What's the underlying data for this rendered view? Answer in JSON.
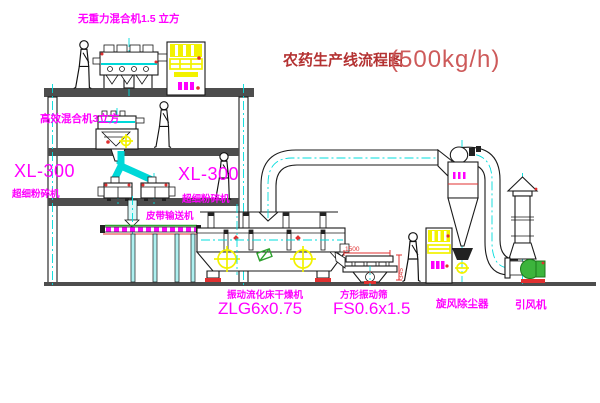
{
  "title": {
    "text": "农药生产线流程图",
    "capacity": "(500kg/h)"
  },
  "labels": {
    "gravity_mixer": "无重力混合机1.5 立方",
    "high_eff_mixer": "高效混合机3立方",
    "mill_left_model": "XL-300",
    "mill_left_name": "超细粉碎机",
    "mill_center_model": "XL-300",
    "mill_center_name": "超细粉碎机",
    "belt_conveyor": "皮带输送机",
    "fluid_bed_dryer": "振动流化床干燥机",
    "fluid_bed_dryer_model": "ZLG6x0.75",
    "square_sieve": "方形振动筛",
    "square_sieve_model": "FS0.6x1.5",
    "cyclone": "旋风除尘器",
    "draft_fan": "引风机"
  },
  "dimensions": {
    "sieve_length": "1500",
    "sieve_height": "345"
  },
  "colors": {
    "label_magenta": "#ff00ff",
    "title_red": "#b43232",
    "capacity_red": "#cd5a5a",
    "centerline_cyan": "#00dcdc",
    "equipment_yellow": "#f2f200",
    "motor_green": "#3cb43c",
    "base_red": "#e03030",
    "structure_gray": "#4d4d4d"
  }
}
